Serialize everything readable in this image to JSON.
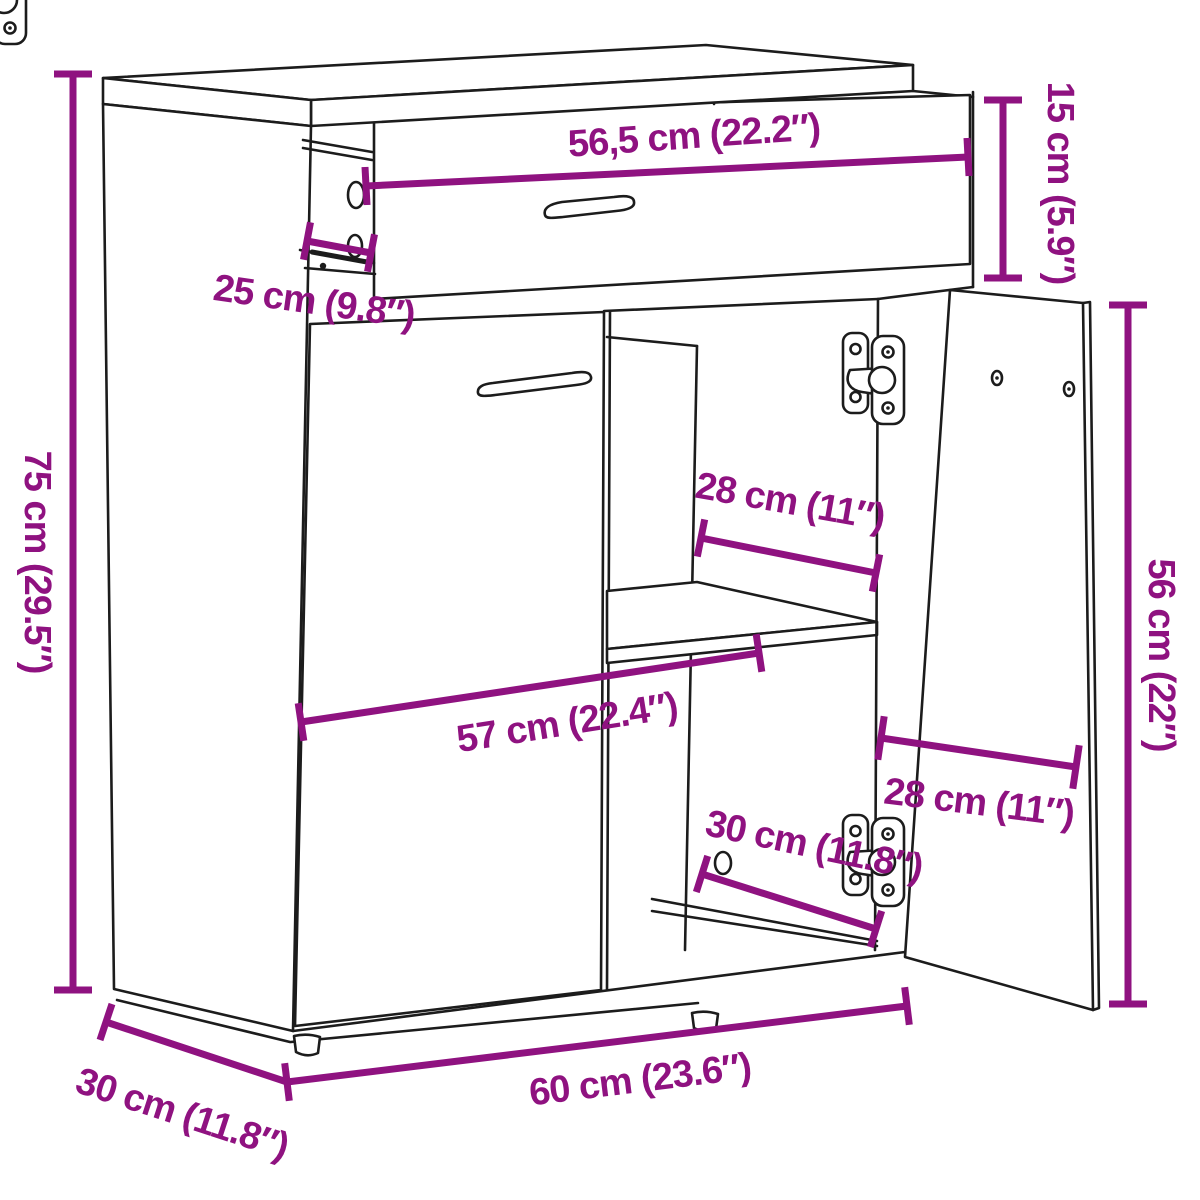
{
  "diagram": {
    "type": "furniture-dimension-diagram",
    "subject": "sideboard-with-drawer-and-2-doors",
    "background_color": "#ffffff",
    "line_color": "#1c1c1c",
    "dimension_color": "#8f1280",
    "dimensions": [
      {
        "id": "drawer_width",
        "label": "56,5 cm (22.2″)",
        "cm": 56.5,
        "inches": 22.2
      },
      {
        "id": "drawer_height",
        "label": "15 cm (5.9″)",
        "cm": 15,
        "inches": 5.9
      },
      {
        "id": "drawer_depth",
        "label": "25 cm (9.8″)",
        "cm": 25,
        "inches": 9.8
      },
      {
        "id": "overall_height",
        "label": "75 cm (29.5″)",
        "cm": 75,
        "inches": 29.5
      },
      {
        "id": "shelf_depth",
        "label": "28 cm (11″)",
        "cm": 28,
        "inches": 11
      },
      {
        "id": "door_height",
        "label": "56 cm (22″)",
        "cm": 56,
        "inches": 22
      },
      {
        "id": "interior_width",
        "label": "57 cm (22.4″)",
        "cm": 57,
        "inches": 22.4
      },
      {
        "id": "door_width",
        "label": "28 cm (11″)",
        "cm": 28,
        "inches": 11
      },
      {
        "id": "compartment_height",
        "label": "30 cm (11.8″)",
        "cm": 30,
        "inches": 11.8
      },
      {
        "id": "overall_width",
        "label": "60 cm (23.6″)",
        "cm": 60,
        "inches": 23.6
      },
      {
        "id": "overall_depth",
        "label": "30 cm (11.8″)",
        "cm": 30,
        "inches": 11.8
      }
    ]
  }
}
